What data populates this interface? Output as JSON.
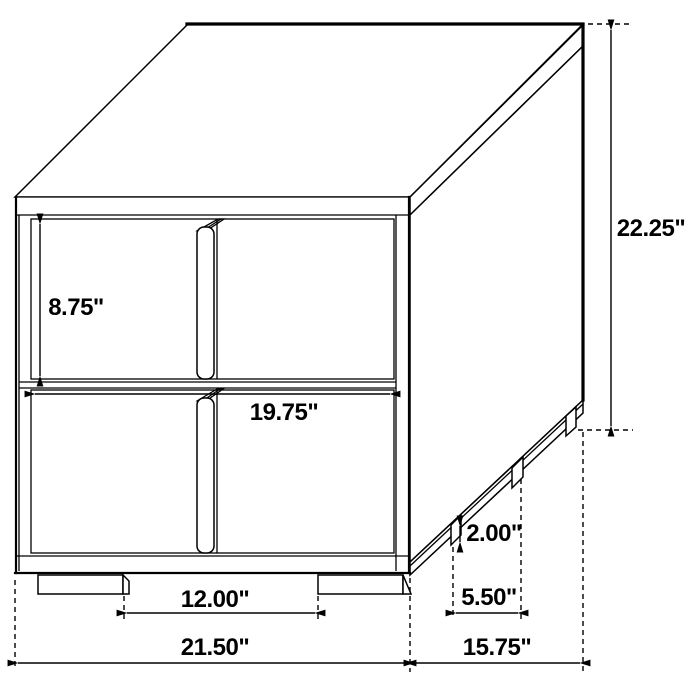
{
  "figure": {
    "type": "furniture-dimension-diagram",
    "subject": "two-drawer nightstand isometric line drawing",
    "unit": "inches",
    "style": {
      "line_color": "#000000",
      "background_color": "#ffffff",
      "text_color": "#000000"
    },
    "dims": {
      "drawer_opening_height": "8.75\"",
      "overall_height": "22.25\"",
      "drawer_front_width": "19.75\"",
      "foot_height": "2.00\"",
      "side_foot_spacing": "5.50\"",
      "front_foot_spacing": "12.00\"",
      "overall_width": "21.50\"",
      "overall_depth": "15.75\""
    }
  }
}
